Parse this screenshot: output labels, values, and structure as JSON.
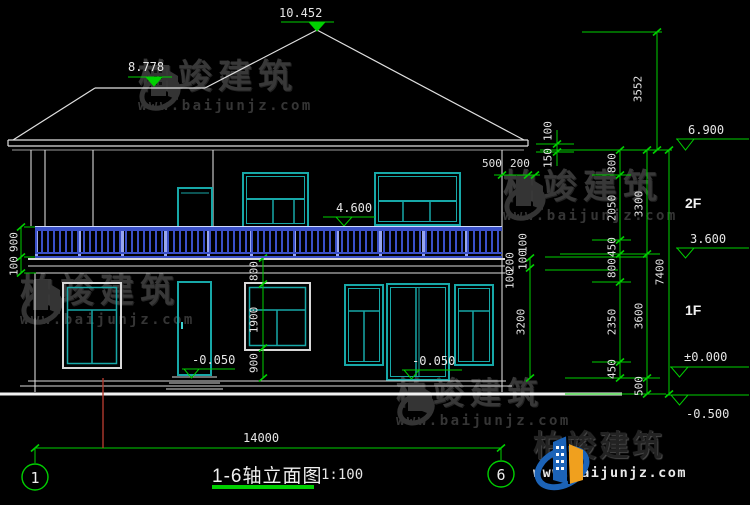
{
  "title": {
    "name": "1-6轴立面图",
    "scale": "1:100"
  },
  "axes": {
    "left_bubble": "1",
    "right_bubble": "6"
  },
  "floors": {
    "second": "2F",
    "first": "1F"
  },
  "watermark": {
    "brand": "柏竣建筑",
    "url": "www.baijunjz.com"
  },
  "elevations": {
    "roof_peak": "10.452",
    "roof_low_ridge": "8.778",
    "balcony": "4.600",
    "eave": "6.900",
    "second_floor": "3.600",
    "zero": "±0.000",
    "site": "-0.500",
    "door_left": "-0.050",
    "door_right": "-0.050"
  },
  "dims": {
    "overall_width": "14000",
    "roof_height": "3552",
    "right_chain_inner": [
      "800",
      "2050",
      "450",
      "800",
      "2350",
      "450"
    ],
    "right_chain_mid": [
      "3300",
      "3600",
      "500"
    ],
    "right_chain_outer": "7400",
    "eave_vertical": [
      "100",
      "150"
    ],
    "eave_overhang": [
      "500",
      "200"
    ],
    "balcony_edge": [
      "100",
      "100",
      "200",
      "100"
    ],
    "first_floor_opening": "3200",
    "left_railing_height": "900",
    "left_slab": "100",
    "window_chain": [
      "800",
      "1900",
      "900"
    ]
  },
  "colors": {
    "background": "#000000",
    "line": "#e4e4e4",
    "annotation_green": "#00d000",
    "frame_teal": "#17a8a8",
    "railing_blue": "#3a50c8",
    "axis_red": "#b03a2e",
    "logo_blue": "#1c63b7",
    "logo_orange": "#f0a01e"
  }
}
